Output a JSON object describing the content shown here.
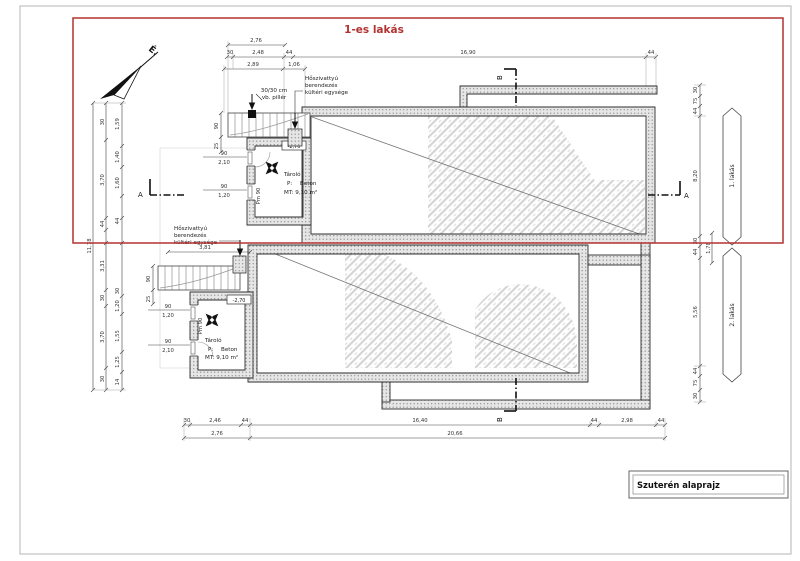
{
  "colors": {
    "accent_red": "#b23230",
    "line": "#2e2e2e",
    "dim_text": "#333333",
    "wall_fill": "#e6e6e6",
    "wall_dot": "#909090",
    "hatch": "#d4d4d4"
  },
  "labels": {
    "flat_overlay": "1-es lakás",
    "north": "É.",
    "title": "Szuterén alaprajz",
    "section_a": "A",
    "section_b": "B",
    "flat1": "1. lakás",
    "flat2": "2. lakás",
    "pillar_l1": "30/30 cm",
    "pillar_l2": "vb. pillér",
    "hp_l1": "Hőszivattyú",
    "hp_l2": "berendezés",
    "hp_l3": "kültéri egysége",
    "room_name": "Tároló",
    "room_p": "P:",
    "room_p_val": "Beton",
    "room_mt": "MT: 9,10 m²",
    "room_level": "-2,70",
    "room_pm": "Pm 90"
  },
  "dims": {
    "top_total": "2,76",
    "top_row": [
      "30",
      "2,48",
      "44",
      "16,90",
      "44"
    ],
    "top_sub": [
      "2,89",
      "1,06"
    ],
    "bottom_row": [
      "30",
      "2,46",
      "44",
      "16,40",
      "44",
      "2,98",
      "44"
    ],
    "bottom_total": [
      "2,76",
      "20,66"
    ],
    "right": [
      "30",
      "75",
      "44",
      "8,20",
      "30",
      "44",
      "5,56",
      "44",
      "75",
      "30"
    ],
    "right_mid": "1,78",
    "left_outer": "11,78",
    "left_mid": [
      "30",
      "3,70",
      "44",
      "3,31",
      "30",
      "3,70",
      "30"
    ],
    "left_inner": [
      "1,59",
      "1,40",
      "1,60",
      "44",
      "30",
      "1,20",
      "1,55",
      "1,25",
      "14"
    ],
    "stair_width": "90",
    "stair_tread": "25",
    "stair_len": "3,81",
    "door_w": "90",
    "door_h_tall": "2,10",
    "door_h_low": "1,20"
  }
}
